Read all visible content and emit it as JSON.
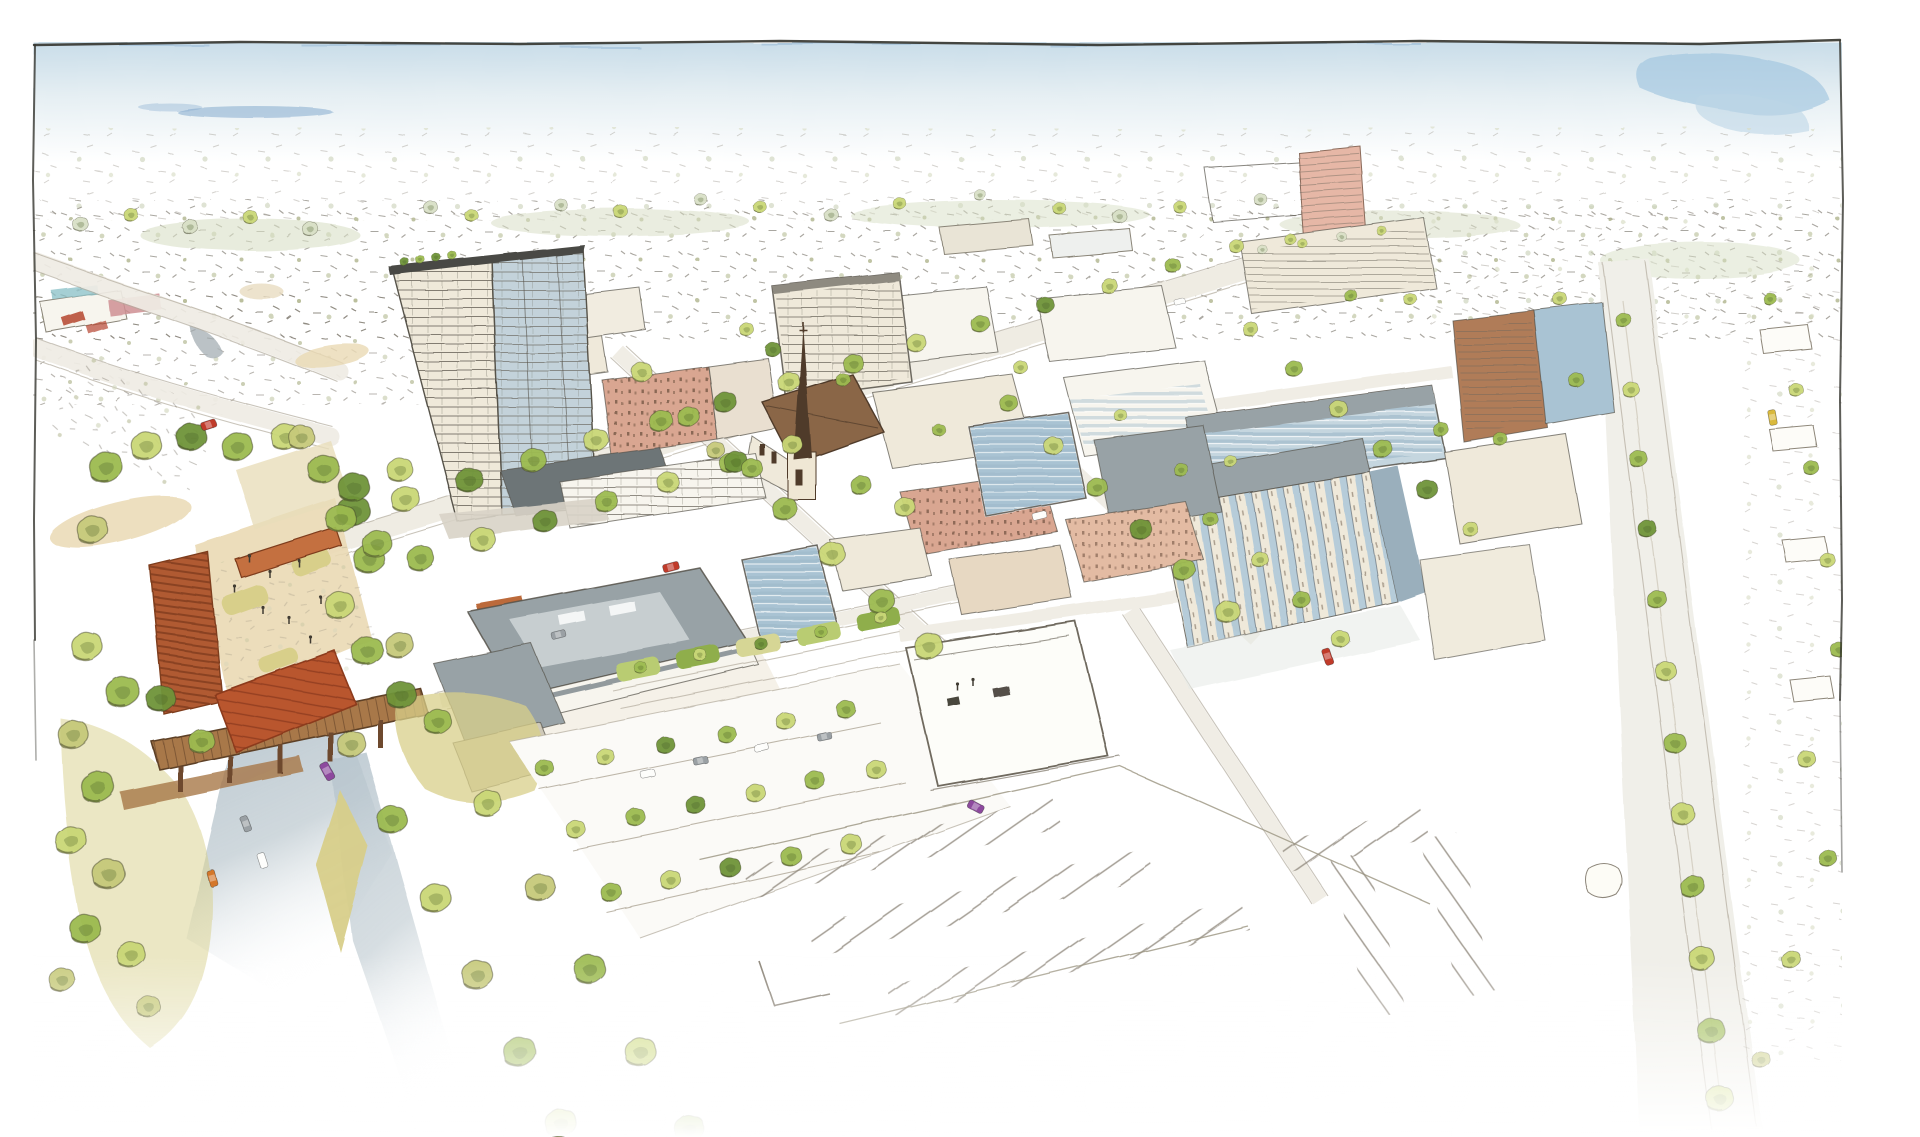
{
  "scene": {
    "title": "Watercolor aerial rendering of a mixed-use district masterplan",
    "medium": "ink sketch with watercolor wash",
    "view": "bird's-eye perspective looking toward the horizon"
  },
  "palette": {
    "paper": "#ffffff",
    "frame": "#34342e",
    "sky_top": "#c9dde9",
    "sky_mid": "#e6eff3",
    "sky_blue": "#9fc4de",
    "sky_streak": "#6f9cc6",
    "sage": "#d8dfc6",
    "speck": "#7a7468",
    "line": "#56524a",
    "tree_light": "#c9d776",
    "tree_mid": "#9cba50",
    "tree_dark": "#6f9339",
    "tree_olive": "#c6c97a",
    "olive_bank": "#d8cf8a",
    "canopy": "#b9562f",
    "canopy_dark": "#8c3a1d",
    "rust_trellis": "#b05a32",
    "wood": "#a87848",
    "wood_dark": "#6e4a2e",
    "road_sunken": "#b6c4cd",
    "road_pale": "#efece4",
    "ground_tan": "#ead9b4",
    "roof_gray": "#98a2a6",
    "roof_dark": "#6d7477",
    "roof_light": "#c7ced0",
    "wall_cream": "#efe9da",
    "wall_white": "#f7f5ee",
    "glass_blue": "#a9c3d3",
    "glass_deep": "#7fa3b8",
    "brick_salmon": "#d9a691",
    "brick_red": "#b5452f",
    "brick_brown": "#b07b58",
    "spire": "#4f3b2a",
    "church_roof": "#8a6647",
    "stall": "#a8a194",
    "car_red": "#c03a2b",
    "car_orange": "#d4772a",
    "car_purple": "#8d4a9e",
    "car_yellow": "#d9b93c",
    "car_gray": "#9aa0a4",
    "car_white": "#fdfdfb"
  },
  "trees": {
    "upper_band": [
      [
        80,
        225,
        0.6,
        0,
        "sage"
      ],
      [
        130,
        215,
        0.55,
        0,
        "tree_light"
      ],
      [
        190,
        228,
        0.6,
        0,
        "sage"
      ],
      [
        250,
        218,
        0.55,
        0,
        "tree_light"
      ],
      [
        310,
        230,
        0.6,
        0,
        "sage"
      ],
      [
        430,
        208,
        0.55,
        0,
        "sage"
      ],
      [
        470,
        215,
        0.5,
        0,
        "tree_light"
      ],
      [
        560,
        205,
        0.5,
        0,
        "sage"
      ],
      [
        620,
        212,
        0.55,
        0,
        "tree_light"
      ],
      [
        700,
        200,
        0.5,
        0,
        "sage"
      ],
      [
        760,
        208,
        0.5,
        0,
        "tree_light"
      ],
      [
        830,
        215,
        0.55,
        0,
        "sage"
      ],
      [
        900,
        205,
        0.5,
        0,
        "tree_light"
      ],
      [
        980,
        196,
        0.45,
        0,
        "sage"
      ],
      [
        1060,
        210,
        0.5,
        0,
        "tree_light"
      ],
      [
        1120,
        218,
        0.55,
        0,
        "sage"
      ],
      [
        1180,
        208,
        0.5,
        0,
        "tree_light"
      ],
      [
        1260,
        200,
        0.5,
        0,
        "sage"
      ]
    ],
    "boulevard": [
      [
        340,
        520,
        1.15,
        0,
        "tree_mid"
      ],
      [
        404,
        500,
        1.1,
        0,
        "tree_light"
      ],
      [
        468,
        481,
        1.05,
        0,
        "tree_dark"
      ],
      [
        532,
        461,
        1.0,
        0,
        "tree_mid"
      ],
      [
        596,
        442,
        0.95,
        0,
        "tree_light"
      ],
      [
        660,
        422,
        0.92,
        0,
        "tree_mid"
      ],
      [
        724,
        403,
        0.88,
        0,
        "tree_dark"
      ],
      [
        788,
        383,
        0.85,
        0,
        "tree_light"
      ],
      [
        852,
        364,
        0.8,
        0,
        "tree_mid"
      ],
      [
        916,
        344,
        0.76,
        0,
        "tree_light"
      ],
      [
        980,
        325,
        0.72,
        0,
        "tree_mid"
      ],
      [
        1044,
        305,
        0.68,
        0,
        "tree_dark"
      ],
      [
        1108,
        286,
        0.64,
        0,
        "tree_light"
      ],
      [
        1172,
        266,
        0.6,
        0,
        "tree_mid"
      ],
      [
        1236,
        247,
        0.56,
        0,
        "tree_light"
      ],
      [
        352,
        488,
        1.2,
        0,
        "tree_dark"
      ],
      [
        376,
        545,
        1.15,
        0,
        "tree_mid"
      ],
      [
        398,
        470,
        1.0,
        0,
        "tree_light"
      ]
    ],
    "boulevard_south": [
      [
        420,
        560,
        1.05,
        0,
        "tree_mid"
      ],
      [
        482,
        541,
        1.0,
        0,
        "tree_light"
      ],
      [
        544,
        522,
        0.95,
        0,
        "tree_dark"
      ],
      [
        606,
        503,
        0.9,
        0,
        "tree_mid"
      ],
      [
        668,
        484,
        0.85,
        0,
        "tree_light"
      ],
      [
        730,
        465,
        0.82,
        0,
        "tree_mid"
      ],
      [
        792,
        446,
        0.78,
        0,
        "tree_light"
      ]
    ],
    "cross1": [
      [
        640,
        372,
        0.8,
        0,
        "tree_light"
      ],
      [
        688,
        418,
        0.85,
        0,
        "tree_mid"
      ],
      [
        736,
        464,
        0.9,
        0,
        "tree_dark"
      ],
      [
        784,
        510,
        0.95,
        0,
        "tree_mid"
      ],
      [
        832,
        556,
        1.0,
        0,
        "tree_light"
      ],
      [
        880,
        602,
        1.05,
        0,
        "tree_mid"
      ],
      [
        928,
        648,
        1.1,
        0,
        "tree_light"
      ]
    ],
    "cross2": [
      [
        1008,
        404,
        0.7,
        0,
        "tree_mid"
      ],
      [
        1052,
        446,
        0.75,
        0,
        "tree_light"
      ],
      [
        1096,
        488,
        0.8,
        0,
        "tree_mid"
      ],
      [
        1140,
        530,
        0.85,
        0,
        "tree_dark"
      ],
      [
        1184,
        572,
        0.9,
        0,
        "tree_mid"
      ],
      [
        1228,
        614,
        0.95,
        0,
        "tree_light"
      ]
    ],
    "cross3": [
      [
        1250,
        330,
        0.6,
        0,
        "tree_light"
      ],
      [
        1294,
        370,
        0.66,
        0,
        "tree_mid"
      ],
      [
        1338,
        410,
        0.7,
        0,
        "tree_light"
      ],
      [
        1382,
        450,
        0.76,
        0,
        "tree_mid"
      ],
      [
        1426,
        490,
        0.8,
        0,
        "tree_dark"
      ]
    ],
    "park": [
      [
        104,
        468,
        1.3,
        0,
        "tree_mid"
      ],
      [
        146,
        448,
        1.2,
        0,
        "tree_light"
      ],
      [
        190,
        438,
        1.15,
        0,
        "tree_dark"
      ],
      [
        236,
        448,
        1.2,
        0,
        "tree_mid"
      ],
      [
        284,
        438,
        1.1,
        0,
        "tree_light"
      ],
      [
        322,
        470,
        1.2,
        0,
        "tree_mid"
      ],
      [
        352,
        512,
        1.25,
        0,
        "tree_dark"
      ],
      [
        368,
        560,
        1.2,
        0,
        "tree_mid"
      ],
      [
        300,
        438,
        1.0,
        0,
        "tree_olive"
      ],
      [
        92,
        532,
        1.2,
        0,
        "tree_olive"
      ],
      [
        122,
        694,
        1.3,
        0,
        "tree_mid"
      ],
      [
        86,
        648,
        1.2,
        0,
        "tree_light"
      ],
      [
        338,
        606,
        1.15,
        0,
        "tree_light"
      ],
      [
        366,
        652,
        1.2,
        0,
        "tree_mid"
      ],
      [
        398,
        646,
        1.1,
        0,
        "tree_olive"
      ],
      [
        400,
        696,
        1.15,
        0,
        "tree_dark"
      ]
    ],
    "embankment": [
      [
        72,
        736,
        1.2,
        0,
        "tree_olive"
      ],
      [
        96,
        788,
        1.3,
        0,
        "tree_mid"
      ],
      [
        70,
        842,
        1.2,
        0,
        "tree_light"
      ],
      [
        108,
        876,
        1.25,
        0,
        "tree_olive"
      ],
      [
        84,
        930,
        1.2,
        0,
        "tree_mid"
      ],
      [
        130,
        956,
        1.1,
        0,
        "tree_light"
      ],
      [
        60,
        980,
        1.0,
        0,
        "tree_olive"
      ],
      [
        160,
        700,
        1.1,
        0,
        "tree_dark"
      ],
      [
        200,
        742,
        1.0,
        0,
        "tree_mid"
      ],
      [
        148,
        1008,
        0.9,
        0,
        "tree_olive"
      ]
    ],
    "bottomleft_a": [
      [
        350,
        745,
        1.1,
        0,
        "tree_olive"
      ],
      [
        392,
        822,
        1.15,
        0,
        "tree_mid"
      ],
      [
        434,
        899,
        1.2,
        0,
        "tree_light"
      ],
      [
        476,
        976,
        1.2,
        0,
        "tree_olive"
      ],
      [
        518,
        1053,
        1.25,
        0,
        "tree_mid"
      ],
      [
        560,
        1125,
        1.2,
        0,
        "tree_light"
      ]
    ],
    "bottomleft_b": [
      [
        436,
        722,
        1.05,
        0,
        "tree_mid"
      ],
      [
        487,
        805,
        1.1,
        0,
        "tree_light"
      ],
      [
        538,
        888,
        1.15,
        0,
        "tree_olive"
      ],
      [
        589,
        971,
        1.2,
        0,
        "tree_mid"
      ],
      [
        640,
        1054,
        1.2,
        0,
        "tree_light"
      ],
      [
        688,
        1130,
        1.15,
        0,
        "tree_mid"
      ]
    ],
    "parking_rows": [
      [
        545,
        770,
        0.7,
        0,
        "tree_mid"
      ],
      [
        605,
        758,
        0.7,
        0,
        "tree_light"
      ],
      [
        665,
        746,
        0.72,
        0,
        "tree_dark"
      ],
      [
        725,
        734,
        0.72,
        0,
        "tree_mid"
      ],
      [
        785,
        722,
        0.74,
        0,
        "tree_light"
      ],
      [
        845,
        710,
        0.74,
        0,
        "tree_mid"
      ],
      [
        575,
        830,
        0.74,
        0,
        "tree_light"
      ],
      [
        635,
        818,
        0.74,
        0,
        "tree_mid"
      ],
      [
        695,
        806,
        0.76,
        0,
        "tree_dark"
      ],
      [
        755,
        794,
        0.76,
        0,
        "tree_light"
      ],
      [
        815,
        782,
        0.78,
        0,
        "tree_mid"
      ],
      [
        875,
        770,
        0.78,
        0,
        "tree_light"
      ],
      [
        610,
        893,
        0.8,
        0,
        "tree_mid"
      ],
      [
        670,
        881,
        0.8,
        0,
        "tree_light"
      ],
      [
        730,
        869,
        0.82,
        0,
        "tree_dark"
      ],
      [
        790,
        857,
        0.82,
        0,
        "tree_mid"
      ],
      [
        850,
        845,
        0.84,
        0,
        "tree_light"
      ]
    ],
    "courtyards": [
      [
        640,
        668,
        0.5,
        0,
        "tree_mid"
      ],
      [
        700,
        656,
        0.5,
        0,
        "tree_light"
      ],
      [
        760,
        644,
        0.5,
        0,
        "tree_dark"
      ],
      [
        820,
        632,
        0.5,
        0,
        "tree_mid"
      ],
      [
        880,
        618,
        0.5,
        0,
        "tree_light"
      ]
    ],
    "church": [
      [
        752,
        470,
        0.8,
        0,
        "tree_mid"
      ],
      [
        772,
        350,
        0.6,
        0,
        "tree_dark"
      ],
      [
        746,
        330,
        0.55,
        0,
        "tree_light"
      ],
      [
        860,
        486,
        0.8,
        0,
        "tree_mid"
      ],
      [
        904,
        508,
        0.8,
        0,
        "tree_light"
      ],
      [
        716,
        452,
        0.7,
        0,
        "tree_olive"
      ]
    ],
    "grid_scatter": [
      [
        842,
        380,
        0.55,
        0,
        "tree_mid"
      ],
      [
        1020,
        368,
        0.55,
        0,
        "tree_light"
      ],
      [
        938,
        430,
        0.5,
        0,
        "tree_mid"
      ],
      [
        1120,
        416,
        0.5,
        0,
        "tree_light"
      ],
      [
        1210,
        520,
        0.6,
        0,
        "tree_mid"
      ],
      [
        1259,
        560,
        0.65,
        0,
        "tree_light"
      ],
      [
        1300,
        600,
        0.7,
        0,
        "tree_mid"
      ],
      [
        1340,
        640,
        0.7,
        0,
        "tree_light"
      ]
    ],
    "right_cluster": [
      [
        1180,
        470,
        0.55,
        0,
        "tree_mid"
      ],
      [
        1230,
        462,
        0.5,
        0,
        "tree_light"
      ],
      [
        1440,
        430,
        0.6,
        0,
        "tree_mid"
      ],
      [
        1470,
        530,
        0.6,
        0,
        "tree_light"
      ],
      [
        1500,
        440,
        0.55,
        0,
        "tree_mid"
      ],
      [
        1410,
        300,
        0.5,
        0,
        "tree_light"
      ],
      [
        1350,
        296,
        0.5,
        0,
        "tree_mid"
      ],
      [
        1290,
        240,
        0.45,
        0,
        "tree_light"
      ]
    ],
    "roof_tower": [
      [
        404,
        262,
        0.35,
        0,
        "tree_dark"
      ],
      [
        420,
        260,
        0.35,
        0,
        "tree_mid"
      ],
      [
        436,
        258,
        0.35,
        0,
        "tree_dark"
      ],
      [
        452,
        256,
        0.35,
        0,
        "tree_mid"
      ]
    ],
    "roof_r4": [
      [
        1262,
        250,
        0.38,
        0,
        "sage"
      ],
      [
        1302,
        244,
        0.38,
        0,
        "tree_light"
      ],
      [
        1342,
        238,
        0.38,
        0,
        "sage"
      ],
      [
        1382,
        232,
        0.38,
        0,
        "tree_light"
      ]
    ],
    "right_avenue": [
      [
        1622,
        320,
        0.6,
        0,
        "tree_mid"
      ],
      [
        1630,
        390,
        0.65,
        0,
        "tree_light"
      ],
      [
        1638,
        460,
        0.7,
        0,
        "tree_mid"
      ],
      [
        1647,
        530,
        0.72,
        0,
        "tree_dark"
      ],
      [
        1656,
        600,
        0.76,
        0,
        "tree_mid"
      ],
      [
        1665,
        672,
        0.8,
        0,
        "tree_light"
      ],
      [
        1674,
        744,
        0.85,
        0,
        "tree_mid"
      ],
      [
        1683,
        816,
        0.9,
        0,
        "tree_light"
      ],
      [
        1692,
        888,
        0.95,
        0,
        "tree_mid"
      ],
      [
        1701,
        960,
        1.0,
        0,
        "tree_light"
      ],
      [
        1710,
        1032,
        1.05,
        0,
        "tree_mid"
      ],
      [
        1719,
        1100,
        1.05,
        0,
        "tree_light"
      ],
      [
        1560,
        300,
        0.55,
        0,
        "tree_light"
      ],
      [
        1575,
        380,
        0.6,
        0,
        "tree_mid"
      ]
    ],
    "neighborhood": [
      [
        1770,
        300,
        0.5,
        0,
        "tree_mid"
      ],
      [
        1795,
        390,
        0.55,
        0,
        "tree_light"
      ],
      [
        1812,
        470,
        0.6,
        0,
        "tree_mid"
      ],
      [
        1826,
        560,
        0.6,
        0,
        "tree_light"
      ],
      [
        1838,
        650,
        0.65,
        0,
        "tree_mid"
      ],
      [
        1806,
        760,
        0.7,
        0,
        "tree_light"
      ],
      [
        1828,
        860,
        0.7,
        0,
        "tree_mid"
      ],
      [
        1790,
        960,
        0.75,
        0,
        "tree_light"
      ],
      [
        1760,
        1060,
        0.7,
        0,
        "tree_olive"
      ]
    ]
  },
  "cars": {
    "list": [
      [
        208,
        424,
        0.85,
        -18,
        "car_red"
      ],
      [
        671,
        567,
        0.9,
        -15,
        "car_red"
      ],
      [
        1328,
        657,
        0.9,
        72,
        "car_red"
      ],
      [
        328,
        772,
        1.0,
        62,
        "car_purple"
      ],
      [
        975,
        806,
        0.95,
        28,
        "car_purple"
      ],
      [
        212,
        878,
        0.9,
        75,
        "car_orange"
      ],
      [
        246,
        824,
        0.85,
        70,
        "car_gray"
      ],
      [
        262,
        860,
        0.85,
        72,
        "car_white"
      ],
      [
        1040,
        516,
        0.8,
        -14,
        "car_white"
      ],
      [
        700,
        760,
        0.8,
        -12,
        "car_gray"
      ],
      [
        762,
        748,
        0.8,
        -12,
        "car_white"
      ],
      [
        824,
        736,
        0.8,
        -12,
        "car_gray"
      ],
      [
        648,
        774,
        0.8,
        -12,
        "car_white"
      ],
      [
        1773,
        418,
        0.85,
        80,
        "car_yellow"
      ],
      [
        1180,
        302,
        0.6,
        -14,
        "car_white"
      ],
      [
        560,
        636,
        0.8,
        -14,
        "car_gray"
      ]
    ]
  },
  "figures": {
    "plaza": [
      [
        250,
        560,
        1,
        0
      ],
      [
        270,
        575,
        1,
        0
      ],
      [
        300,
        565,
        1,
        0
      ],
      [
        262,
        610,
        1,
        0
      ],
      [
        288,
        620,
        1,
        0
      ],
      [
        310,
        640,
        1,
        0
      ],
      [
        235,
        590,
        1,
        0
      ],
      [
        320,
        600,
        1,
        0
      ],
      [
        958,
        688,
        1,
        0
      ],
      [
        974,
        684,
        1,
        0
      ]
    ]
  }
}
